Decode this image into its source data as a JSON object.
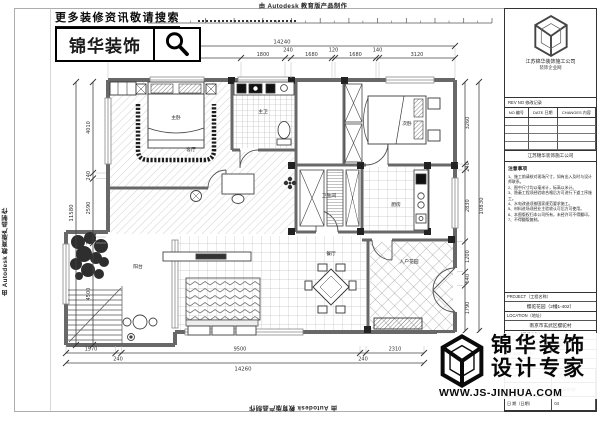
{
  "banners": {
    "autodesk": "由 Autodesk 教育版产品制作"
  },
  "header": {
    "search_hint": "更多装修资讯敬请搜索",
    "brand": "锦华装饰"
  },
  "plan": {
    "rooms": {
      "master_bedroom": "主卧",
      "living": "客厅",
      "master_bath": "主卫",
      "bedroom2": "次卧",
      "bathroom": "卫生间",
      "kitchen": "厨房",
      "dining": "餐厅",
      "entry_garden": "入户花园",
      "balcony": "阳台"
    },
    "dims": {
      "top_total": "14240",
      "top": [
        "5470",
        "1800",
        "240",
        "1680",
        "120",
        "1680",
        "140",
        "3120"
      ],
      "left_total": "11580",
      "left": [
        "4010",
        "240",
        "2590",
        "240",
        "4500"
      ],
      "right_total": "10830",
      "right": [
        "3260",
        "240",
        "2830",
        "1200",
        "540",
        "1790"
      ],
      "bottom_total": "14260",
      "bottom": [
        "1970",
        "240",
        "9500",
        "240",
        "2310"
      ]
    }
  },
  "title_block": {
    "company_top": "江苏锦华装饰施工公司",
    "company_top2": "装饰企业网",
    "revision_caption": "REV NO 修改记录",
    "rev_headers": [
      "NO 编号",
      "DATE 日期",
      "CHANGES 内容"
    ],
    "company_row": "江苏锦华装饰施工公司",
    "notes_title": "注意事项",
    "notes": [
      "1、施工前请核对现场尺寸，如有出入及时与设计师联系。",
      "2、图中尺寸均以毫米计，标高以米计。",
      "3、隐蔽工程须经验收合格后方可进行下道工序施工。",
      "4、水电改造须按国家规范要求施工。",
      "5、材料进场须经业主验收认可后方可使用。",
      "6、本图版权归本公司所有，未经许可不得翻印。",
      "7、不得翻版复制。"
    ],
    "fields": [
      {
        "label": "PROJECT（工程名称）",
        "value": "樱驼花园（2幢1-402）"
      },
      {
        "label": "LOCATION（地址）",
        "value": "南京市玄武区樱驼村"
      },
      {
        "label": "TITLE（图纸名称）",
        "value": "平面布置示意图"
      },
      {
        "label": "SCALE（比例）",
        "value": "1：100"
      }
    ],
    "sign_rows": [
      {
        "label": "设 计（设计）",
        "value": "（签名有效）"
      },
      {
        "label": "制 图（制图）",
        "value": "（盖章有效）"
      },
      {
        "label": "日 期（日期）",
        "value": "04"
      }
    ]
  },
  "footer_logo": {
    "brand1": "锦华装饰",
    "brand2": "设计专家",
    "site": "WWW.JS-JINHUA.COM"
  }
}
